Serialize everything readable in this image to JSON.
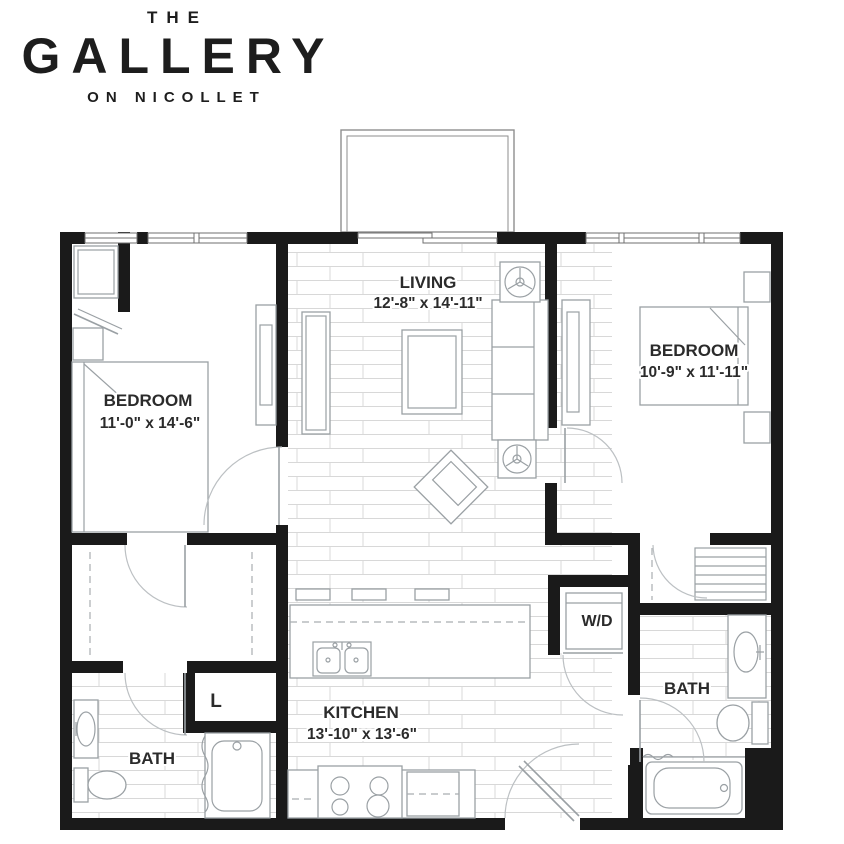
{
  "brand": {
    "the": "THE",
    "name": "GALLERY",
    "tagline": "ON NICOLLET"
  },
  "rooms": {
    "living": {
      "name": "LIVING",
      "dims": "12'-8\" x 14'-11\""
    },
    "bedroom1": {
      "name": "BEDROOM",
      "dims": "11'-0\" x 14'-6\""
    },
    "bedroom2": {
      "name": "BEDROOM",
      "dims": "10'-9\" x 11'-11\""
    },
    "kitchen": {
      "name": "KITCHEN",
      "dims": "13'-10\" x 13'-6\""
    },
    "bath1": {
      "name": "BATH"
    },
    "bath2": {
      "name": "BATH"
    },
    "laundry": {
      "label": "W/D"
    },
    "linen": {
      "label": "L"
    }
  },
  "colors": {
    "wall": "#1a1a1a",
    "furniture_line": "#9aa0a4",
    "floor_line": "#d8d8d8",
    "label_text": "#2b2b2b",
    "background": "#ffffff"
  }
}
